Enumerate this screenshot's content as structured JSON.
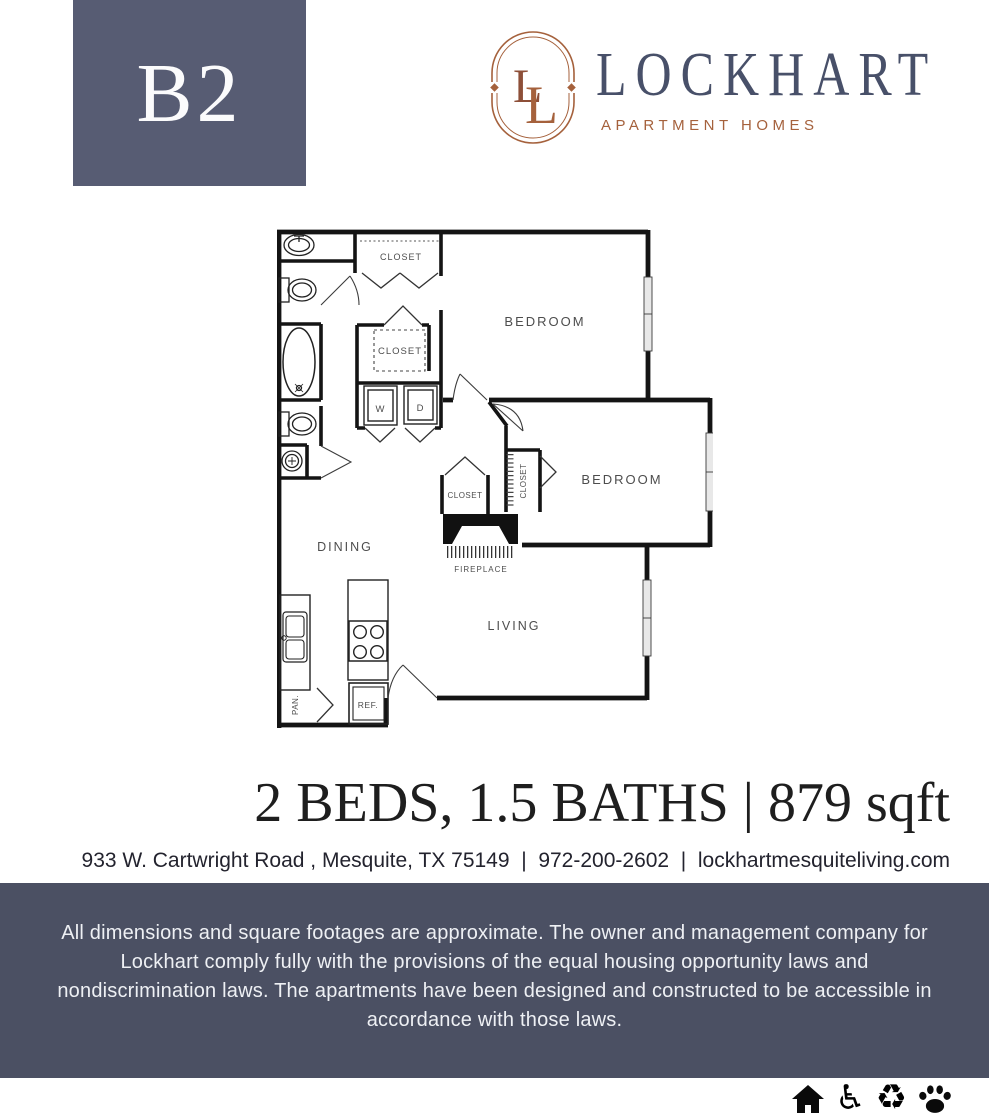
{
  "palette": {
    "badge_bg": "#575c73",
    "footer_bg": "#4b5063",
    "rust": "#a5613c",
    "rust_dark": "#8d4f38",
    "brand_ink": "#485069",
    "ink": "#1e1e1e",
    "plan_label_gray": "#4d4d4d"
  },
  "header": {
    "unit": "B2",
    "brand": {
      "monogram_l1": "L",
      "monogram_l2": "L",
      "name": "LOCKHART",
      "tagline": "APARTMENT HOMES"
    }
  },
  "plan": {
    "labels": {
      "bedroom1": "BEDROOM",
      "bedroom2": "BEDROOM",
      "dining": "DINING",
      "living": "LIVING",
      "fireplace": "FIREPLACE",
      "closet_hall": "CLOSET",
      "closet_mid": "CLOSET",
      "closet_nook": "CLOSET",
      "closet_bed2": "CLOSET",
      "washer": "W",
      "dryer": "D",
      "fridge": "REF.",
      "pantry": "PAN."
    }
  },
  "summary": {
    "specs": "2 BEDS, 1.5 BATHS | 879 sqft",
    "address": "933 W. Cartwright Road , Mesquite, TX 75149  |  972-200-2602  |  lockhartmesquiteliving.com"
  },
  "footer": {
    "disclaimer": "All dimensions and square footages are approximate. The owner and management company for Lockhart comply fully with the provisions of the equal housing opportunity laws and nondiscrimination laws. The apartments have been designed and constructed to be accessible in accordance with those laws.",
    "icons": {
      "accessible_glyph": "♿",
      "recycle_glyph": "♻"
    }
  }
}
